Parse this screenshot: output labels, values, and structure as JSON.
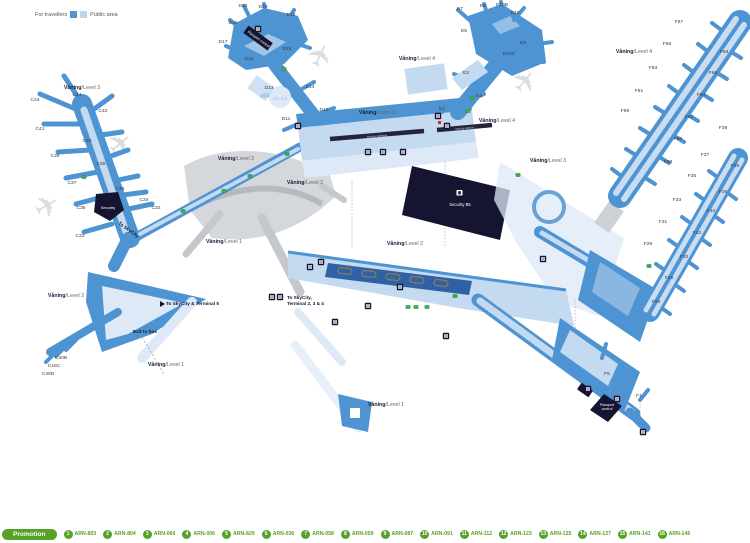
{
  "colors": {
    "blue": "#4f94d2",
    "blue_light": "#c3daf0",
    "blue_lighter": "#dde9f7",
    "blue_dark": "#2f62a4",
    "navy": "#151532",
    "gray": "#cdd1d6",
    "marker_green": "#3fae49",
    "promo_green": "#55a228",
    "white": "#ffffff"
  },
  "legend": {
    "travellers_label": "For travellers",
    "public_label": "Public area"
  },
  "promo_bar": {
    "promotion_label": "Promotion",
    "items": [
      {
        "num": "1",
        "code": "ARN-803"
      },
      {
        "num": "2",
        "code": "ARN-804"
      },
      {
        "num": "3",
        "code": "ARN-065"
      },
      {
        "num": "4",
        "code": "ARN-006"
      },
      {
        "num": "5",
        "code": "ARN-829"
      },
      {
        "num": "6",
        "code": "ARN-036"
      },
      {
        "num": "7",
        "code": "ARN-058"
      },
      {
        "num": "8",
        "code": "ARN-059"
      },
      {
        "num": "9",
        "code": "ARN-087"
      },
      {
        "num": "10",
        "code": "ARN-091"
      },
      {
        "num": "11",
        "code": "ARN-112"
      },
      {
        "num": "12",
        "code": "ARN-123"
      },
      {
        "num": "13",
        "code": "ARN-125"
      },
      {
        "num": "14",
        "code": "ARN-127"
      },
      {
        "num": "15",
        "code": "ARN-141"
      },
      {
        "num": "16",
        "code": "ARN-146"
      }
    ]
  },
  "map": {
    "level_labels": [
      {
        "text": "Våning/Level 3",
        "x": 82,
        "y": 89
      },
      {
        "text": "Våning/Level 3",
        "x": 377,
        "y": 114
      },
      {
        "text": "Våning/Level 3",
        "x": 548,
        "y": 162
      },
      {
        "text": "Våning/Level 4",
        "x": 417,
        "y": 60
      },
      {
        "text": "Våning/Level 4",
        "x": 497,
        "y": 122
      },
      {
        "text": "Våning/Level 4",
        "x": 634,
        "y": 53
      },
      {
        "text": "Våning/Level 2",
        "x": 236,
        "y": 160
      },
      {
        "text": "Våning/Level 2",
        "x": 305,
        "y": 184
      },
      {
        "text": "Våning/Level 2",
        "x": 405,
        "y": 245
      },
      {
        "text": "Våning/Level 2",
        "x": 66,
        "y": 297
      },
      {
        "text": "Våning/Level 1",
        "x": 224,
        "y": 243
      },
      {
        "text": "Våning/Level 1",
        "x": 166,
        "y": 366
      },
      {
        "text": "Våning/Level 1",
        "x": 386,
        "y": 406
      }
    ],
    "gate_labels": [
      {
        "id": "C44",
        "x": 77,
        "y": 96
      },
      {
        "id": "C43",
        "x": 35,
        "y": 101
      },
      {
        "id": "C42",
        "x": 103,
        "y": 112
      },
      {
        "id": "C41",
        "x": 40,
        "y": 130
      },
      {
        "id": "C40",
        "x": 87,
        "y": 142
      },
      {
        "id": "C39",
        "x": 55,
        "y": 157
      },
      {
        "id": "C38",
        "x": 101,
        "y": 165
      },
      {
        "id": "C37",
        "x": 72,
        "y": 184
      },
      {
        "id": "C36",
        "x": 120,
        "y": 190
      },
      {
        "id": "C35",
        "x": 81,
        "y": 209
      },
      {
        "id": "C34",
        "x": 144,
        "y": 201
      },
      {
        "id": "C32",
        "x": 156,
        "y": 209
      },
      {
        "id": "C33",
        "x": 80,
        "y": 237
      },
      {
        "id": "C30B",
        "x": 61,
        "y": 359
      },
      {
        "id": "C18C",
        "x": 54,
        "y": 367
      },
      {
        "id": "C30D",
        "x": 48,
        "y": 375
      },
      {
        "id": "D24",
        "x": 243,
        "y": 7
      },
      {
        "id": "D20",
        "x": 263,
        "y": 8
      },
      {
        "id": "D18",
        "x": 291,
        "y": 16
      },
      {
        "id": "D19",
        "x": 233,
        "y": 24
      },
      {
        "id": "D17",
        "x": 223,
        "y": 43
      },
      {
        "id": "D16",
        "x": 287,
        "y": 50
      },
      {
        "id": "D15",
        "x": 249,
        "y": 60
      },
      {
        "id": "D13",
        "x": 269,
        "y": 89
      },
      {
        "id": "D14",
        "x": 310,
        "y": 88
      },
      {
        "id": "D12",
        "x": 324,
        "y": 111
      },
      {
        "id": "D11",
        "x": 286,
        "y": 120
      },
      {
        "id": "E7",
        "x": 460,
        "y": 10
      },
      {
        "id": "E9",
        "x": 483,
        "y": 7
      },
      {
        "id": "E10B",
        "x": 502,
        "y": 6
      },
      {
        "id": "E10",
        "x": 515,
        "y": 14
      },
      {
        "id": "E5",
        "x": 464,
        "y": 32
      },
      {
        "id": "E8",
        "x": 523,
        "y": 44
      },
      {
        "id": "E10C",
        "x": 509,
        "y": 55
      },
      {
        "id": "E3",
        "x": 466,
        "y": 74
      },
      {
        "id": "E4",
        "x": 479,
        "y": 97
      },
      {
        "id": "E1",
        "x": 442,
        "y": 110
      },
      {
        "id": "F67",
        "x": 679,
        "y": 23
      },
      {
        "id": "F65",
        "x": 667,
        "y": 45
      },
      {
        "id": "F63",
        "x": 653,
        "y": 69
      },
      {
        "id": "F61",
        "x": 639,
        "y": 92
      },
      {
        "id": "F59",
        "x": 625,
        "y": 112
      },
      {
        "id": "F68",
        "x": 724,
        "y": 53
      },
      {
        "id": "F66",
        "x": 713,
        "y": 74
      },
      {
        "id": "F64",
        "x": 701,
        "y": 96
      },
      {
        "id": "F62",
        "x": 689,
        "y": 118
      },
      {
        "id": "F60",
        "x": 678,
        "y": 140
      },
      {
        "id": "F58",
        "x": 668,
        "y": 163
      },
      {
        "id": "F39",
        "x": 723,
        "y": 129
      },
      {
        "id": "F37",
        "x": 705,
        "y": 156
      },
      {
        "id": "F35",
        "x": 692,
        "y": 177
      },
      {
        "id": "F33",
        "x": 677,
        "y": 201
      },
      {
        "id": "F31",
        "x": 663,
        "y": 223
      },
      {
        "id": "F29",
        "x": 648,
        "y": 245
      },
      {
        "id": "F38",
        "x": 735,
        "y": 167
      },
      {
        "id": "F36",
        "x": 723,
        "y": 193
      },
      {
        "id": "F34",
        "x": 711,
        "y": 212
      },
      {
        "id": "F32",
        "x": 697,
        "y": 234
      },
      {
        "id": "F30",
        "x": 684,
        "y": 258
      },
      {
        "id": "F28",
        "x": 669,
        "y": 279
      },
      {
        "id": "F26",
        "x": 656,
        "y": 303
      },
      {
        "id": "F5",
        "x": 607,
        "y": 375
      },
      {
        "id": "F1",
        "x": 639,
        "y": 397
      }
    ],
    "facility_labels": [
      {
        "id": "security-c",
        "text": "Security",
        "x": 108,
        "y": 209,
        "fill": "#ffffff",
        "size": 4,
        "rot": 0
      },
      {
        "id": "passport-d",
        "text": "Passport control",
        "x": 258,
        "y": 40,
        "fill": "#ffffff",
        "size": 3.6,
        "rot": 36
      },
      {
        "id": "security-b5",
        "text": "Security B5",
        "x": 460,
        "y": 206,
        "fill": "#ffffff",
        "size": 4.2,
        "rot": 0
      },
      {
        "id": "passport-f",
        "lines": [
          "Passport",
          "control"
        ],
        "x": 607,
        "y": 406,
        "fill": "#ffffff",
        "size": 3.6,
        "rot": 0
      },
      {
        "id": "sky-bar",
        "text": "Sky Bar",
        "x": 280,
        "y": 100,
        "fill": "#a8c0dc",
        "size": 4.2,
        "rot": 0
      },
      {
        "id": "walkway-1",
        "text": "Moving walkway",
        "x": 377,
        "y": 137,
        "fill": "#cfd6e2",
        "size": 2.8,
        "rot": -5
      },
      {
        "id": "walkway-2",
        "text": "Moving walkway",
        "x": 465,
        "y": 129,
        "fill": "#cfd6e2",
        "size": 2.6,
        "rot": -5
      }
    ],
    "annotations": [
      {
        "text": "To SkyCity & Terminal 5",
        "x": 166,
        "y": 305,
        "rot": 0
      },
      {
        "text": "Exit to bus",
        "x": 133,
        "y": 333,
        "rot": 0
      },
      {
        "text": "To SkyCity,",
        "x": 287,
        "y": 299,
        "rot": 0
      },
      {
        "text": "Terminal 2, 3 & 4",
        "x": 287,
        "y": 305,
        "rot": 0
      },
      {
        "text": "To SkyCity",
        "x": 118,
        "y": 224,
        "rot": 35
      }
    ],
    "green_markers": [
      [
        84,
        177
      ],
      [
        284,
        69
      ],
      [
        183,
        211
      ],
      [
        224,
        191
      ],
      [
        250,
        176
      ],
      [
        287,
        154
      ],
      [
        472,
        98
      ],
      [
        468,
        111
      ],
      [
        518,
        175
      ],
      [
        408,
        307
      ],
      [
        416,
        307
      ],
      [
        427,
        307
      ],
      [
        455,
        296
      ],
      [
        649,
        266
      ]
    ],
    "black_icons": [
      [
        258,
        29
      ],
      [
        298,
        126
      ],
      [
        438,
        116
      ],
      [
        447,
        126
      ],
      [
        310,
        267
      ],
      [
        321,
        262
      ],
      [
        400,
        287
      ],
      [
        368,
        306
      ],
      [
        335,
        322
      ],
      [
        446,
        336
      ],
      [
        543,
        259
      ],
      [
        588,
        389
      ],
      [
        617,
        399
      ],
      [
        643,
        432
      ],
      [
        272,
        297
      ],
      [
        280,
        297
      ],
      [
        368,
        152
      ],
      [
        383,
        152
      ],
      [
        403,
        152
      ]
    ],
    "planes": [
      {
        "x": 127,
        "y": 152,
        "rot": -40
      },
      {
        "x": 52,
        "y": 215,
        "rot": -30
      },
      {
        "x": 330,
        "y": 60,
        "rot": -65
      },
      {
        "x": 533,
        "y": 88,
        "rot": -50
      }
    ]
  }
}
